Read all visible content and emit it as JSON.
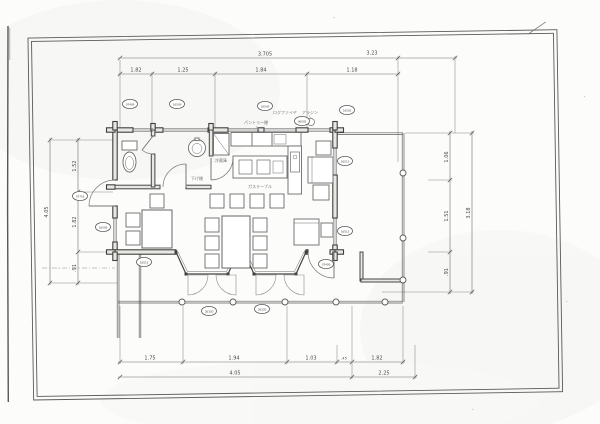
{
  "plan": {
    "labels": {
      "refrigerator": "冷蔵庫",
      "lower_shelf": "下げ棚",
      "pantry_shelf": "パントリー棚",
      "log_fire": "ログファイヤ",
      "aladdin_stove": "アラジン",
      "gas_table": "ガステーブル"
    },
    "window_codes": {
      "top_wc": "07409",
      "top_wash": "16509",
      "top_kitchen": "16509",
      "top_kitchen2": "06005",
      "top_deck": "16505",
      "left_door": "07718",
      "left_window": "16509",
      "right_window_1": "16513",
      "right_window_2": "16513",
      "bottom_left": "16013",
      "bay_1": "26320",
      "bay_2": "26320",
      "terrace_door": "07409"
    }
  },
  "dimensions": {
    "top": {
      "overall_left": "3.705",
      "overall_right": "3.23",
      "seg1": "1.82",
      "seg2": "1.25",
      "seg3": "1.84",
      "seg4": "1.18"
    },
    "bottom": {
      "seg1": "1.75",
      "seg2": "1.94",
      "seg3": "1.03",
      "seg4": ".45",
      "seg5": "1.82",
      "overall_left": "4.05",
      "overall_right": "2.25"
    },
    "left": {
      "seg1": "1.52",
      "seg2": "1.82",
      "seg3": ".91",
      "overall": "4.05"
    },
    "right": {
      "seg1": "1.06",
      "seg2": "1.51",
      "seg3": ".91",
      "overall": "3.18"
    }
  }
}
